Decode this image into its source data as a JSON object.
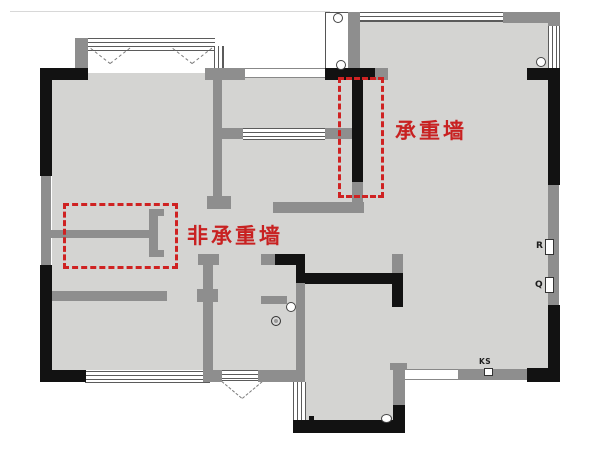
{
  "plan": {
    "title": "apartment-floor-plan",
    "labels": {
      "load_bearing": "承重墙",
      "non_load_bearing": "非承重墙"
    },
    "markers": {
      "r": "R",
      "q": "Q",
      "ks": "KS"
    },
    "colors": {
      "floor": "#d4d4d2",
      "wall_black": "#121212",
      "wall_gray": "#8e8e8e",
      "highlight_red": "#cf2222",
      "background": "#ffffff"
    }
  }
}
